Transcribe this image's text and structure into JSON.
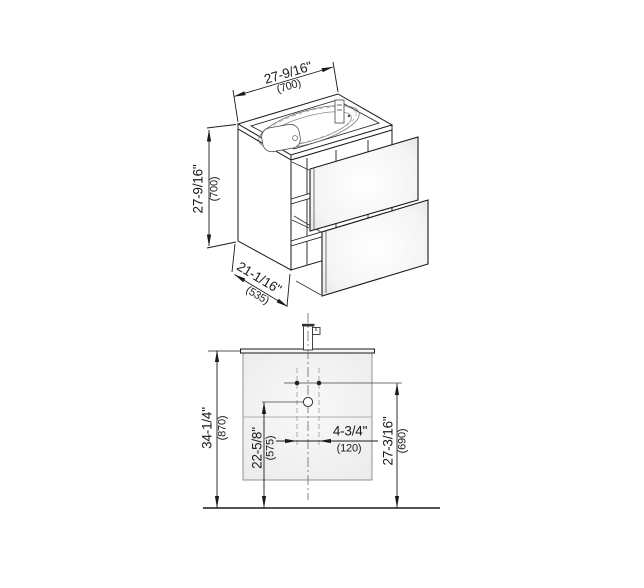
{
  "drawing": {
    "type": "vanity-unit-technical-drawing",
    "colors": {
      "line": "#1a1a1a",
      "thin_line": "#777777",
      "cabinet_fill": "#ededed",
      "panel_fill": "#ffffff",
      "background": "#ffffff"
    },
    "isometric_view": {
      "width": {
        "inches": "27-9/16\"",
        "mm": "(700)"
      },
      "height": {
        "inches": "27-9/16\"",
        "mm": "(700)"
      },
      "depth": {
        "inches": "21-1/16\"",
        "mm": "(535)"
      }
    },
    "front_elevation": {
      "overall_height": {
        "inches": "34-1/4\"",
        "mm": "(870)"
      },
      "drain_height": {
        "inches": "22-5/8\"",
        "mm": "(575)"
      },
      "supply_height": {
        "inches": "27-3/16\"",
        "mm": "(690)"
      },
      "supply_spacing": {
        "inches": "4-3/4\"",
        "mm": "(120)"
      }
    }
  }
}
